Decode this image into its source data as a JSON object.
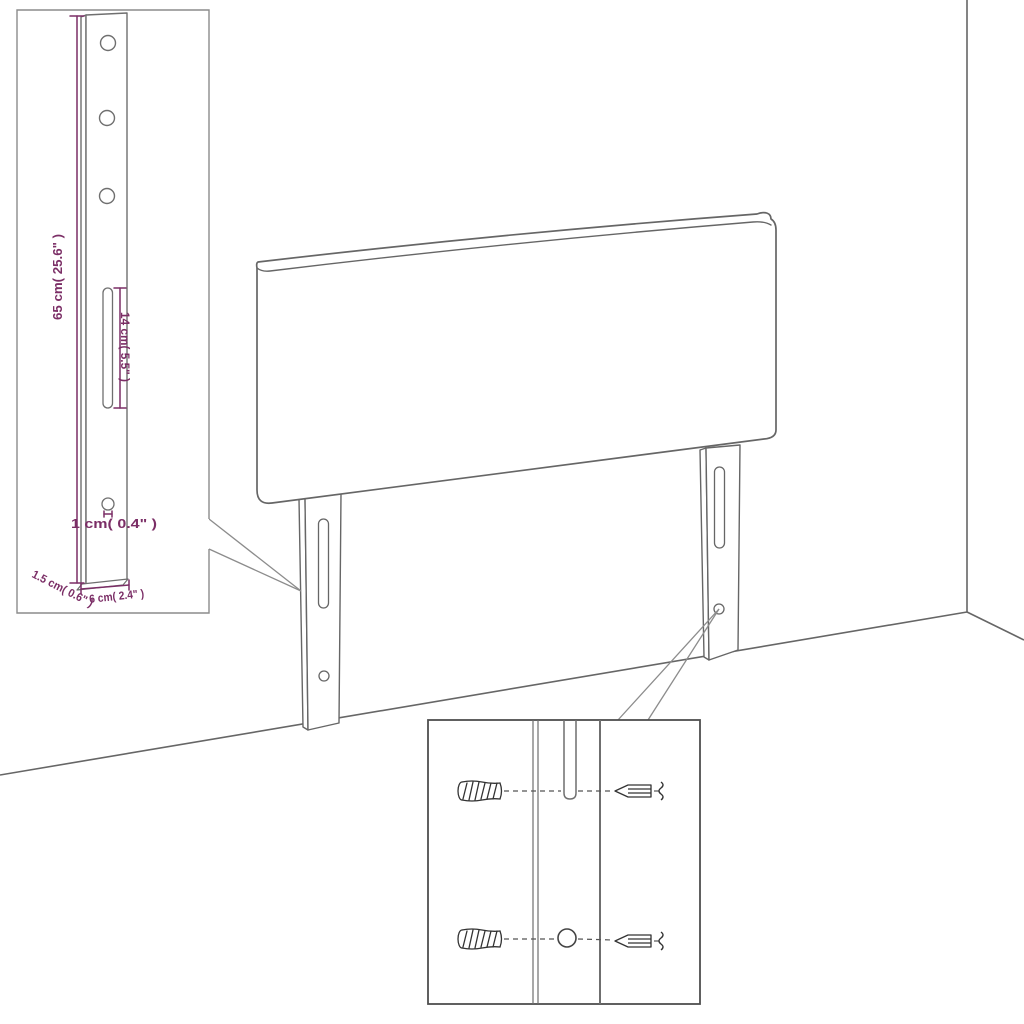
{
  "page": {
    "background": "#ffffff"
  },
  "diagram": {
    "type": "headboard-assembly-diagram",
    "colors": {
      "outline": "#666666",
      "dimension": "#7b2e66",
      "inset_border": "#8c8c8c",
      "hardware": "#333333"
    },
    "leg_detail": {
      "dims": {
        "leg_height": "65 cm( 25.6\" )",
        "slot_length": "14 cm( 5.5\" )",
        "hole_diameter": "1 cm( 0.4\" )",
        "leg_thickness": "1.5 cm( 0.6\" )",
        "leg_width": "6 cm( 2.4\" )"
      }
    },
    "hardware_detail": {
      "parts": [
        "wall-anchor",
        "screw"
      ]
    }
  }
}
